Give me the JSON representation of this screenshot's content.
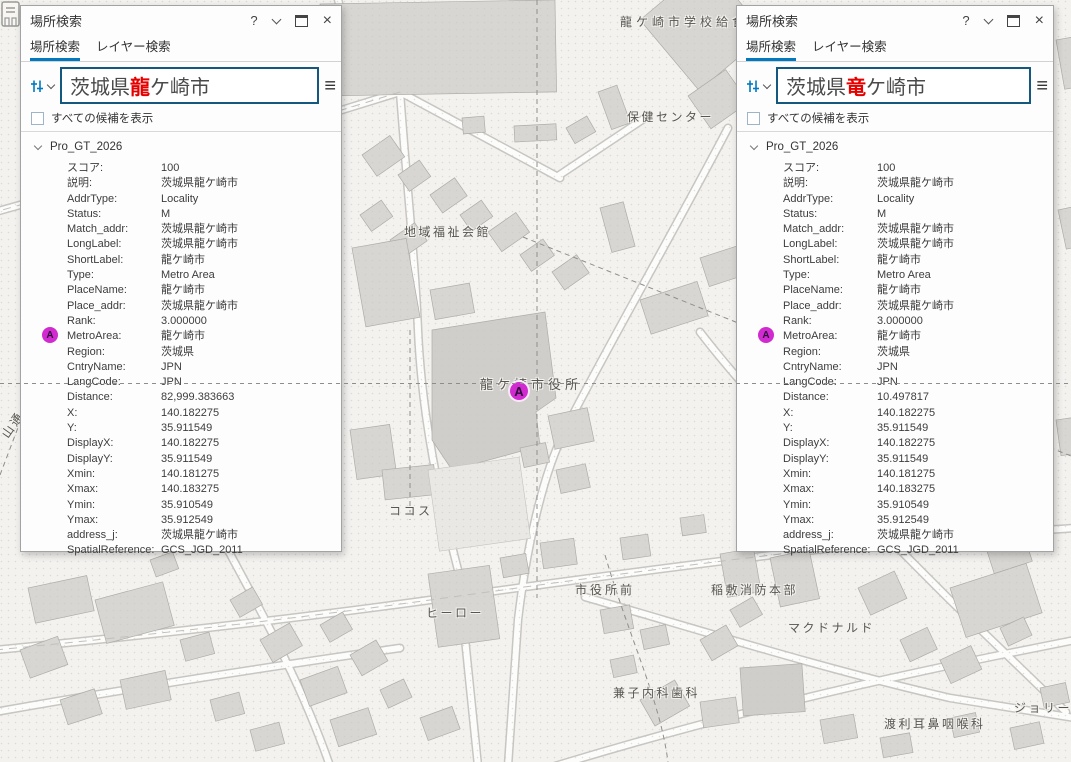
{
  "colors": {
    "accent": "#0079c1",
    "search_border": "#15587f",
    "red": "#e60000",
    "marker": "#d02ad0"
  },
  "icons": {
    "help": "?",
    "close": "×",
    "hamburger": "≡"
  },
  "map": {
    "marker": {
      "label": "A"
    },
    "labels": [
      {
        "text": "龍ケ崎市学校給食セ",
        "x": 620,
        "y": 13,
        "spacing": 4
      },
      {
        "text": "保健センター",
        "x": 627,
        "y": 108
      },
      {
        "text": "地域福祉会館",
        "x": 404,
        "y": 223
      },
      {
        "text": "龍ケ崎市役所",
        "x": 480,
        "y": 374,
        "size": 13,
        "spacing": 4
      },
      {
        "text": "ココス",
        "x": 389,
        "y": 502
      },
      {
        "text": "市役所前",
        "x": 575,
        "y": 581,
        "spacing": 3
      },
      {
        "text": "稲敷消防本部",
        "x": 711,
        "y": 581
      },
      {
        "text": "ヒーロー",
        "x": 426,
        "y": 604
      },
      {
        "text": "マクドナルド",
        "x": 788,
        "y": 619
      },
      {
        "text": "兼子内科歯科",
        "x": 613,
        "y": 684
      },
      {
        "text": "渡利耳鼻咽喉科",
        "x": 884,
        "y": 715
      },
      {
        "text": "ジョリーパ",
        "x": 1014,
        "y": 699
      },
      {
        "text": "山通",
        "x": -2,
        "y": 416,
        "rotate": -55
      }
    ]
  },
  "panels": [
    {
      "title": "場所検索",
      "tabs": [
        {
          "label": "場所検索"
        },
        {
          "label": "レイヤー検索"
        }
      ],
      "search": {
        "prefix": "茨城県",
        "highlight": "龍",
        "suffix": "ケ崎市"
      },
      "checkbox": {
        "label": "すべての候補を表示",
        "checked": false
      },
      "group_label": "Pro_GT_2026",
      "result_icon": "A",
      "attributes": [
        {
          "k": "スコア:",
          "v": "100"
        },
        {
          "k": "説明:",
          "v": "茨城県龍ケ崎市"
        },
        {
          "k": "AddrType:",
          "v": "Locality"
        },
        {
          "k": "Status:",
          "v": "M"
        },
        {
          "k": "Match_addr:",
          "v": "茨城県龍ケ崎市"
        },
        {
          "k": "LongLabel:",
          "v": "茨城県龍ケ崎市"
        },
        {
          "k": "ShortLabel:",
          "v": "龍ケ崎市"
        },
        {
          "k": "Type:",
          "v": "Metro Area"
        },
        {
          "k": "PlaceName:",
          "v": "龍ケ崎市"
        },
        {
          "k": "Place_addr:",
          "v": "茨城県龍ケ崎市"
        },
        {
          "k": "Rank:",
          "v": "3.000000"
        },
        {
          "k": "MetroArea:",
          "v": "龍ケ崎市"
        },
        {
          "k": "Region:",
          "v": "茨城県"
        },
        {
          "k": "CntryName:",
          "v": "JPN"
        },
        {
          "k": "LangCode:",
          "v": "JPN"
        },
        {
          "k": "Distance:",
          "v": "82,999.383663"
        },
        {
          "k": "X:",
          "v": "140.182275"
        },
        {
          "k": "Y:",
          "v": "35.911549"
        },
        {
          "k": "DisplayX:",
          "v": "140.182275"
        },
        {
          "k": "DisplayY:",
          "v": "35.911549"
        },
        {
          "k": "Xmin:",
          "v": "140.181275"
        },
        {
          "k": "Xmax:",
          "v": "140.183275"
        },
        {
          "k": "Ymin:",
          "v": "35.910549"
        },
        {
          "k": "Ymax:",
          "v": "35.912549"
        },
        {
          "k": "address_j:",
          "v": "茨城県龍ケ崎市"
        },
        {
          "k": "SpatialReference:",
          "v": "GCS_JGD_2011"
        }
      ]
    },
    {
      "title": "場所検索",
      "tabs": [
        {
          "label": "場所検索"
        },
        {
          "label": "レイヤー検索"
        }
      ],
      "search": {
        "prefix": "茨城県",
        "highlight": "竜",
        "suffix": "ケ崎市"
      },
      "checkbox": {
        "label": "すべての候補を表示",
        "checked": false
      },
      "group_label": "Pro_GT_2026",
      "result_icon": "A",
      "attributes": [
        {
          "k": "スコア:",
          "v": "100"
        },
        {
          "k": "説明:",
          "v": "茨城県龍ケ崎市"
        },
        {
          "k": "AddrType:",
          "v": "Locality"
        },
        {
          "k": "Status:",
          "v": "M"
        },
        {
          "k": "Match_addr:",
          "v": "茨城県龍ケ崎市"
        },
        {
          "k": "LongLabel:",
          "v": "茨城県龍ケ崎市"
        },
        {
          "k": "ShortLabel:",
          "v": "龍ケ崎市"
        },
        {
          "k": "Type:",
          "v": "Metro Area"
        },
        {
          "k": "PlaceName:",
          "v": "龍ケ崎市"
        },
        {
          "k": "Place_addr:",
          "v": "茨城県龍ケ崎市"
        },
        {
          "k": "Rank:",
          "v": "3.000000"
        },
        {
          "k": "MetroArea:",
          "v": "龍ケ崎市"
        },
        {
          "k": "Region:",
          "v": "茨城県"
        },
        {
          "k": "CntryName:",
          "v": "JPN"
        },
        {
          "k": "LangCode:",
          "v": "JPN"
        },
        {
          "k": "Distance:",
          "v": "10.497817"
        },
        {
          "k": "X:",
          "v": "140.182275"
        },
        {
          "k": "Y:",
          "v": "35.911549"
        },
        {
          "k": "DisplayX:",
          "v": "140.182275"
        },
        {
          "k": "DisplayY:",
          "v": "35.911549"
        },
        {
          "k": "Xmin:",
          "v": "140.181275"
        },
        {
          "k": "Xmax:",
          "v": "140.183275"
        },
        {
          "k": "Ymin:",
          "v": "35.910549"
        },
        {
          "k": "Ymax:",
          "v": "35.912549"
        },
        {
          "k": "address_j:",
          "v": "茨城県龍ケ崎市"
        },
        {
          "k": "SpatialReference:",
          "v": "GCS_JGD_2011"
        }
      ]
    }
  ]
}
